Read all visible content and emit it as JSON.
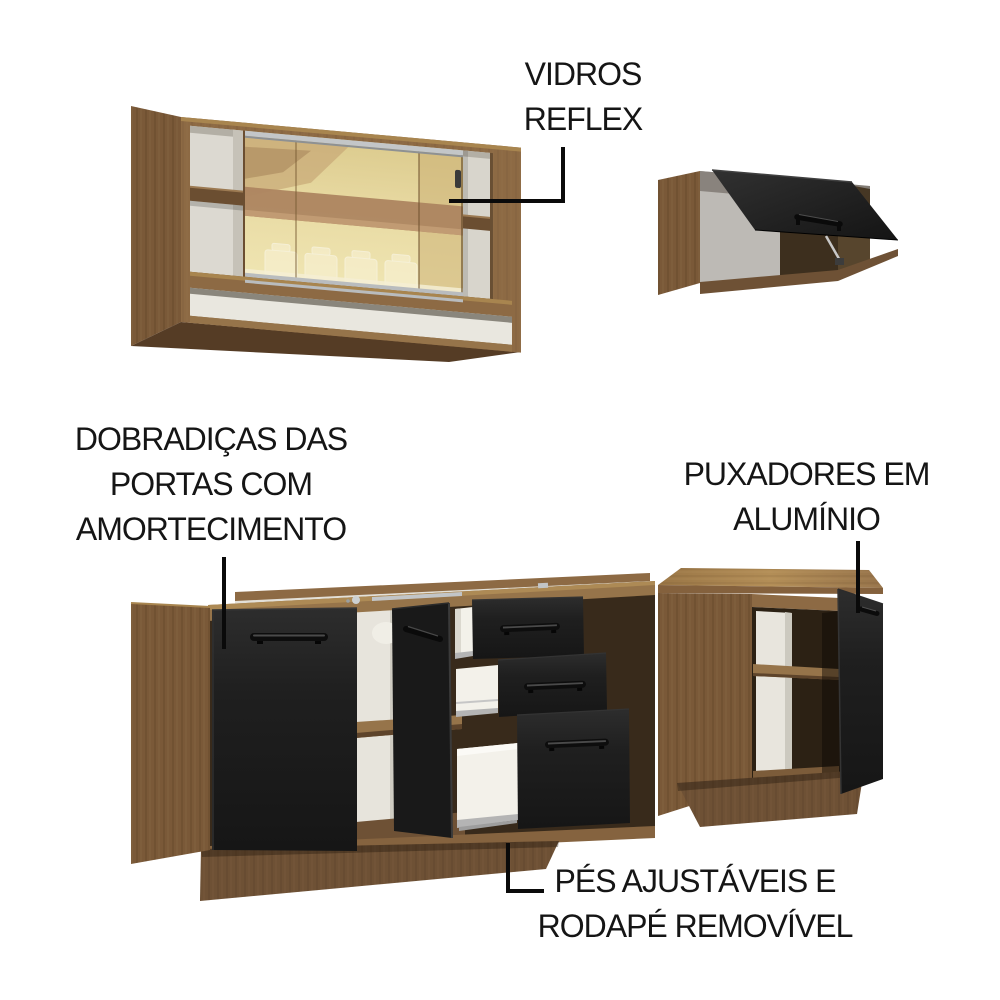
{
  "scene": {
    "background": "#ffffff",
    "description_items": 4
  },
  "annotations": {
    "vidros_reflex": {
      "lines": [
        "VIDROS",
        "REFLEX"
      ]
    },
    "dobradicas": {
      "lines": [
        "DOBRADIÇAS DAS",
        "PORTAS COM",
        "AMORTECIMENTO"
      ]
    },
    "puxadores": {
      "lines": [
        "PUXADORES EM",
        "ALUMÍNIO"
      ]
    },
    "pes_rodape": {
      "lines": [
        "PÉS AJUSTÁVEIS E",
        "RODAPÉ REMOVÍVEL"
      ]
    }
  },
  "colors": {
    "annotation_text": "#151515",
    "callout_line": "#0a0a0a",
    "wood_front": "#8d6a44",
    "wood_side": "#7a5938",
    "wood_dark": "#6e5135",
    "wood_light": "#a8854f",
    "door_black": "#1e1e1e",
    "glass_gold": "#e8d9a2",
    "glass_band": "#ad8560",
    "interior_white": "#e9e7df",
    "drawer_white": "#f3f1ea",
    "metal_silver": "#c0c3c5"
  }
}
